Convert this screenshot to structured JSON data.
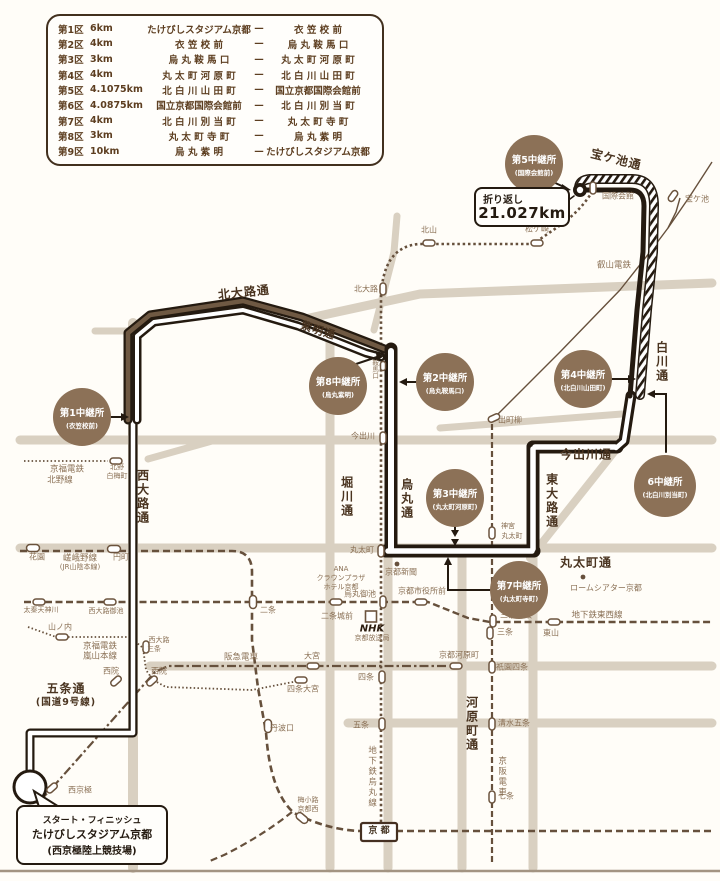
{
  "legend": {
    "dash": "—",
    "rows": [
      {
        "leg": "第1区",
        "dist": "6km",
        "from": "たけびしスタジアム京都",
        "to": "衣 笠 校 前"
      },
      {
        "leg": "第2区",
        "dist": "4km",
        "from": "衣 笠 校 前",
        "to": "烏 丸 鞍 馬 口"
      },
      {
        "leg": "第3区",
        "dist": "3km",
        "from": "烏 丸 鞍 馬 口",
        "to": "丸 太 町 河 原 町"
      },
      {
        "leg": "第4区",
        "dist": "4km",
        "from": "丸 太 町 河 原 町",
        "to": "北 白 川 山 田 町"
      },
      {
        "leg": "第5区",
        "dist": "4.1075km",
        "from": "北 白 川 山 田 町",
        "to": "国立京都国際会館前"
      },
      {
        "leg": "第6区",
        "dist": "4.0875km",
        "from": "国立京都国際会館前",
        "to": "北 白 川 別 当 町"
      },
      {
        "leg": "第7区",
        "dist": "4km",
        "from": "北 白 川 別 当 町",
        "to": "丸 太 町 寺 町"
      },
      {
        "leg": "第8区",
        "dist": "3km",
        "from": "丸 太 町 寺 町",
        "to": "烏 丸 紫 明"
      },
      {
        "leg": "第9区",
        "dist": "10km",
        "from": "烏 丸 紫 明",
        "to": "たけびしスタジアム京都"
      }
    ]
  },
  "map": {
    "roads": {
      "kitaoji": "北大路通",
      "shimei": "紫明通",
      "nishioji": "西大路通",
      "horikawa": "堀川通",
      "karasuma": "烏丸通",
      "kawaramachi": "河原町通",
      "higashioji": "東大路通",
      "shirakawa": "白川通",
      "imadegawa": "今出川通",
      "marutamachi": "丸太町通",
      "gojo": "五条通",
      "gojo_sub": "(国道9号線)",
      "takaragaike": "宝ケ池通"
    },
    "railways": {
      "keifuku_kitano1": "京福電鉄",
      "keifuku_kitano2": "北野線",
      "sagano1": "嵯峨野線",
      "sagano2": "(JR山陰本線)",
      "randen1": "京福電鉄",
      "randen2": "嵐山本線",
      "hankyu": "阪急電車",
      "karasuma_line": "地下鉄烏丸線",
      "tozai_line": "地下鉄東西線",
      "keihan": "京阪電車",
      "eizan": "叡山電鉄"
    },
    "stations": {
      "kitano_hakubaicho1": "北野",
      "kitano_hakubaicho2": "白梅町",
      "hanazono": "花園",
      "enmachi": "円町",
      "uzumasa_tenjingawa": "太秦天神川",
      "nishioji_oike": "西大路御池",
      "yamanouchi": "山ノ内",
      "nishioji_sanjo1": "西大路",
      "nishioji_sanjo2": "三条",
      "saiin_west": "西院",
      "saiin_east": "西院",
      "omiya": "大宮",
      "shijo_omiya": "四条大宮",
      "nishikyogoku": "西京極",
      "nijo": "二条",
      "nijojo_mae": "二条城前",
      "karasuma_oike": "烏丸御池",
      "shiyakusho_mae": "京都市役所前",
      "sanjo_keihan": "三条京阪",
      "sanjo": "三条",
      "higashiyama": "東山",
      "kyoto_kawaramachi": "京都河原町",
      "gion_shijo": "祇園四条",
      "kiyomizu_gojo": "清水五条",
      "shichijo": "七条",
      "gojo": "五条",
      "shijo": "四条",
      "tambaguchi": "丹波口",
      "umekoji1": "梅小路",
      "umekoji2": "京都西",
      "kyoto": "京 都",
      "kitaoji": "北大路",
      "kitayama": "北山",
      "matsugasaki": "松ケ崎",
      "kokusaikaikan": "国際会館",
      "kuramaguchi": "鞍馬口",
      "imadegawa": "今出川",
      "marutamachi": "丸太町",
      "jingu1": "神宮",
      "jingu2": "丸太町",
      "demachiyanagi": "出町柳",
      "takaragaike": "宝ケ池"
    },
    "landmarks": {
      "nhk1": "NHK",
      "nhk2": "京都放送局",
      "kyoto_shimbun": "京都新聞",
      "ana1": "ANA",
      "ana2": "クラウンプラザ",
      "ana3": "ホテル京都",
      "rohm": "ロームシアター京都"
    },
    "relays": {
      "r1": {
        "name": "第1中継所",
        "place": "(衣笠校前)"
      },
      "r2": {
        "name": "第2中継所",
        "place": "(烏丸鞍馬口)"
      },
      "r3": {
        "name": "第3中継所",
        "place": "(丸太町河原町)"
      },
      "r4": {
        "name": "第4中継所",
        "place": "(北白川山田町)"
      },
      "r5": {
        "name": "第5中継所",
        "place": "(国際会館前)"
      },
      "r6": {
        "name": "6中継所",
        "place": "(北白川別当町)"
      },
      "r7": {
        "name": "第7中継所",
        "place": "(丸太町寺町)"
      },
      "r8": {
        "name": "第8中継所",
        "place": "(烏丸紫明)"
      }
    },
    "callouts": {
      "turnaround": {
        "label": "折り返し",
        "value": "21.027km"
      },
      "start": {
        "line1": "スタート・フィニッシュ",
        "line2": "たけびしスタジアム京都",
        "line3": "(西京極陸上競技場)"
      }
    },
    "colors": {
      "course": "#241a10",
      "course_fill_out": "#6f5943",
      "relay_badge": "#8c7157",
      "road_base": "#d9d0c1",
      "rail": "#66503c",
      "text_brown": "#4a3420"
    }
  }
}
